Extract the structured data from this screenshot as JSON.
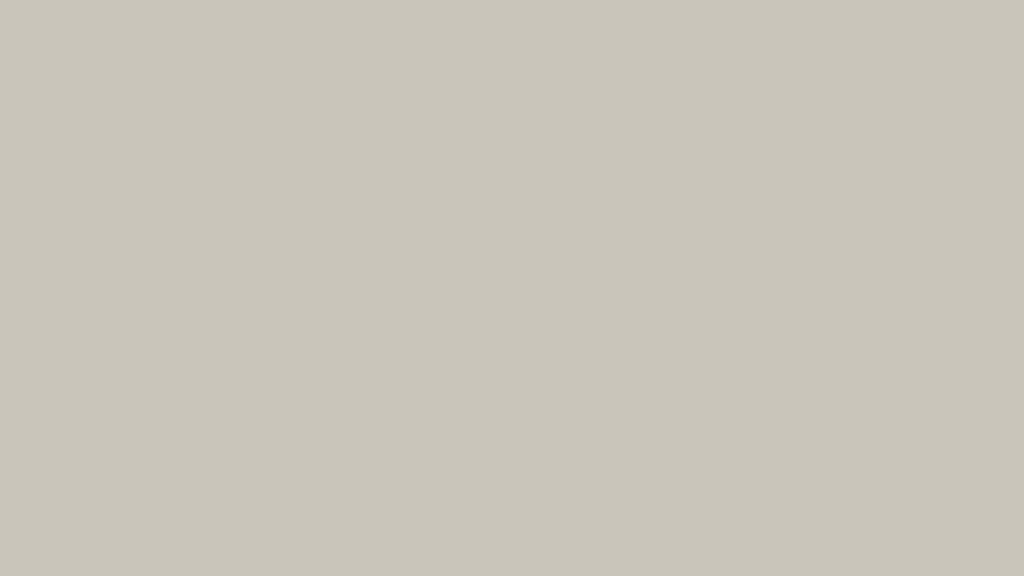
{
  "meta": {
    "title": "Aerial architectural rendering of an urban park masterplan with museum, circular green-roof pavilion, pedestrian bridge over a wide avenue, and lawn with loop path",
    "type": "architectural-visualization",
    "view": "bird's-eye"
  },
  "scene": {
    "labels": [
      "distant-cityscape",
      "elevated-highway",
      "industrial-sheds",
      "city-blocks",
      "sports-field",
      "central-park",
      "pond",
      "green-roof-pavilion",
      "gallery-bar-building",
      "sunken-ovals",
      "playground",
      "basketball-court",
      "metal-swirl-pavilion",
      "west-plaza",
      "umbrella-terrace",
      "museum-complex",
      "glass-lattice-canopy",
      "main-avenue",
      "crosswalk",
      "bus",
      "cars",
      "street-trees",
      "pedestrian-bridge",
      "transit-station",
      "exhibition-hall",
      "southeast-plaza",
      "great-lawn",
      "loop-path",
      "pedestrians"
    ]
  },
  "palette": {
    "hazeTop": "#eceae3",
    "farBase": "#c9c5ba",
    "farMottle": [
      "#bab5a8",
      "#c3bfb3",
      "#a8ab97",
      "#9aa78a",
      "#b5a493",
      "#c7c2b6",
      "#e2ded4"
    ],
    "farRed": "#b65848",
    "cityFace": "#d7dcd1",
    "cityRoof": "#c2cabb",
    "citySide": "#9fa99a",
    "highwayDeck": "#d6d5cf",
    "highwayUnder": "#a3a29a",
    "shedTop": "#e7e9e3",
    "shedSide": "#c3c7be",
    "sageTop": "#d3d9ca",
    "sageSide": "#aab4a5",
    "parkBase1": "#7e985f",
    "parkBase2": "#93ac70",
    "path": "#d3d2ca",
    "treeTones": [
      "#4e6a3c",
      "#5d7c47",
      "#6c8c53",
      "#7b9b60",
      "#8aa96d",
      "#97b478"
    ],
    "lawn1": "#bccb98",
    "lawn2": "#a9bc85",
    "lawnDot": "#97a974",
    "water": "#7fc3c6",
    "asphalt1": "#7a7770",
    "asphalt2": "#5f5d56",
    "lane": "#eae9e3",
    "median": "#d8d6ce",
    "sidewalk": "#c6c5be",
    "plaza": "#d5d4cf",
    "plazaSE": "#cbcbc5",
    "joint": "#bdbcb6",
    "white": "#f2f3f0",
    "whiteShade": "#dfe1dd",
    "glassDark": "#5d6660",
    "canopy1": "#c6d4dc",
    "canopy2": "#a9bcc8",
    "truss": "#f4f7f9",
    "metal1": "#b6c6d2",
    "metal2": "#5e7287",
    "greenRoof": "#8fa768",
    "roofCore": "#e3e4df",
    "barTop": "#66725f",
    "barSide": "#49544a",
    "ovalIn": "#4d4c44",
    "ovalRing": "#cfcec8",
    "kioskTop": "#8a7158",
    "kioskSide": "#6f5b45",
    "sand": "#d8cfb6",
    "playColors": [
      "#e2703a",
      "#d94f3d",
      "#76b043",
      "#e9c33c",
      "#3f8fc4",
      "#8a5ab4"
    ],
    "courtA": "#2e8476",
    "courtB": "#3a9c8a",
    "umbrella": "#dccfae",
    "figures": [
      "#2f2f2d",
      "#45453f",
      "#6b4a3a",
      "#8a3b30",
      "#3c5374",
      "#6e6e68"
    ],
    "hallTop": "#e9e8e2",
    "hallSide": "#d4d3cc",
    "shadow": "rgba(60,60,52,0.3)"
  }
}
